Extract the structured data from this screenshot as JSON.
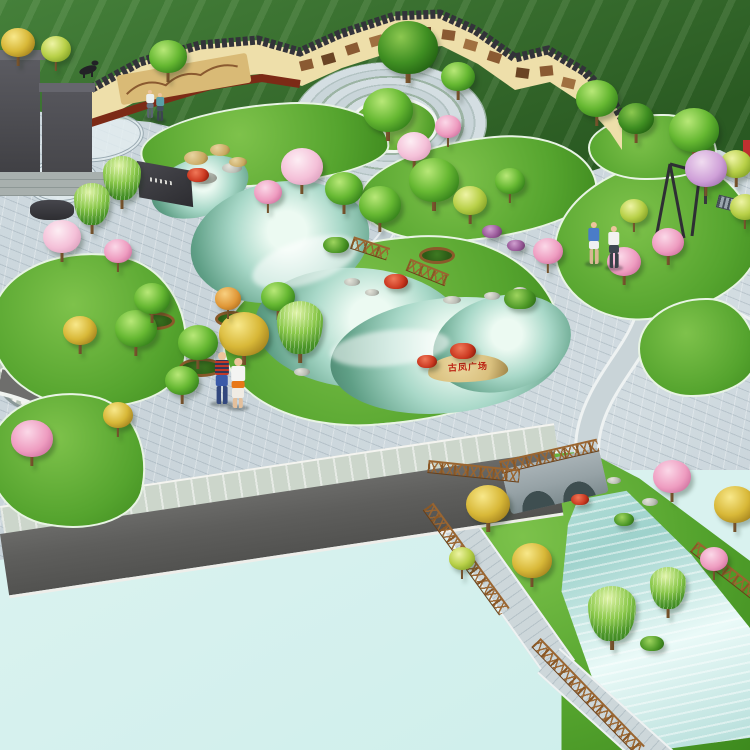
{
  "scene": {
    "title": "Bird's-eye landscape rendering of a cultural plaza park with pond, mural wall, lake and stream garden",
    "inscription": {
      "text": "古凤广场"
    }
  },
  "palette": {
    "field1": "#45803a",
    "field2": "#2a5a22",
    "plaza": "#c9d4da",
    "lawn": "#55a42e",
    "lawnLight": "#7ec24b",
    "lawnEdge": "#e8f4e4",
    "pond": "#5f9f86",
    "pondHi": "#ecfaf2",
    "pale": "#d9f2ef",
    "road": "#5e5e5c",
    "stone": "#d9c07e",
    "insc": "#bc2414",
    "fence": "#8a5826",
    "fenceTop": "#9a6530",
    "bridge": "#96a2a6",
    "arch": "#3e4e50",
    "trunk": "#6b4a26",
    "rock": "#b9bcb4",
    "skin": "#edc49c"
  },
  "trees": [
    {
      "t": "y",
      "x": 18,
      "y": 44,
      "r": 17
    },
    {
      "t": "yg",
      "x": 56,
      "y": 50,
      "r": 15
    },
    {
      "t": "g",
      "x": 168,
      "y": 58,
      "r": 19
    },
    {
      "t": "dg",
      "x": 408,
      "y": 50,
      "r": 30
    },
    {
      "t": "g",
      "x": 458,
      "y": 78,
      "r": 17
    },
    {
      "t": "g",
      "x": 597,
      "y": 100,
      "r": 21
    },
    {
      "t": "dg",
      "x": 636,
      "y": 120,
      "r": 18
    },
    {
      "t": "g",
      "x": 694,
      "y": 132,
      "r": 25
    },
    {
      "t": "yg",
      "x": 736,
      "y": 165,
      "r": 16
    },
    {
      "t": "g",
      "x": 388,
      "y": 112,
      "r": 25
    },
    {
      "t": "lav",
      "x": 706,
      "y": 170,
      "r": 21
    },
    {
      "t": "yg",
      "x": 634,
      "y": 212,
      "r": 14
    },
    {
      "t": "p",
      "x": 668,
      "y": 243,
      "r": 16
    },
    {
      "t": "p",
      "x": 624,
      "y": 263,
      "r": 17
    },
    {
      "t": "yg",
      "x": 745,
      "y": 208,
      "r": 15
    },
    {
      "t": "w",
      "x": 122,
      "y": 180,
      "r": 19
    },
    {
      "t": "r",
      "x": 198,
      "y": 176,
      "r": 11
    },
    {
      "t": "lp",
      "x": 302,
      "y": 168,
      "r": 21
    },
    {
      "t": "p",
      "x": 268,
      "y": 193,
      "r": 14
    },
    {
      "t": "g",
      "x": 344,
      "y": 190,
      "r": 19
    },
    {
      "t": "g",
      "x": 380,
      "y": 206,
      "r": 21
    },
    {
      "t": "g",
      "x": 434,
      "y": 182,
      "r": 25
    },
    {
      "t": "yg",
      "x": 470,
      "y": 202,
      "r": 17
    },
    {
      "t": "lp",
      "x": 414,
      "y": 148,
      "r": 17
    },
    {
      "t": "p",
      "x": 448,
      "y": 128,
      "r": 13
    },
    {
      "t": "g",
      "x": 510,
      "y": 182,
      "r": 15
    },
    {
      "t": "w",
      "x": 300,
      "y": 330,
      "r": 23
    },
    {
      "t": "y",
      "x": 244,
      "y": 336,
      "r": 25
    },
    {
      "t": "g",
      "x": 278,
      "y": 298,
      "r": 17
    },
    {
      "t": "r",
      "x": 396,
      "y": 282,
      "r": 12
    },
    {
      "t": "r",
      "x": 463,
      "y": 352,
      "r": 13
    },
    {
      "t": "r",
      "x": 427,
      "y": 362,
      "r": 10
    },
    {
      "t": "b",
      "x": 336,
      "y": 246,
      "r": 13
    },
    {
      "t": "b",
      "x": 520,
      "y": 300,
      "r": 16
    },
    {
      "t": "p",
      "x": 548,
      "y": 252,
      "r": 15
    },
    {
      "t": "pu",
      "x": 492,
      "y": 232,
      "r": 10
    },
    {
      "t": "pu",
      "x": 516,
      "y": 246,
      "r": 9
    },
    {
      "t": "lp",
      "x": 62,
      "y": 238,
      "r": 19
    },
    {
      "t": "w",
      "x": 92,
      "y": 206,
      "r": 18
    },
    {
      "t": "p",
      "x": 118,
      "y": 252,
      "r": 14
    },
    {
      "t": "g",
      "x": 136,
      "y": 330,
      "r": 21
    },
    {
      "t": "y",
      "x": 80,
      "y": 332,
      "r": 17
    },
    {
      "t": "p",
      "x": 32,
      "y": 440,
      "r": 21
    },
    {
      "t": "y",
      "x": 118,
      "y": 416,
      "r": 15
    },
    {
      "t": "g",
      "x": 182,
      "y": 382,
      "r": 17
    },
    {
      "t": "g",
      "x": 152,
      "y": 300,
      "r": 18
    },
    {
      "t": "g",
      "x": 198,
      "y": 344,
      "r": 20
    },
    {
      "t": "o",
      "x": 228,
      "y": 300,
      "r": 13
    },
    {
      "t": "y",
      "x": 488,
      "y": 506,
      "r": 22
    },
    {
      "t": "y",
      "x": 532,
      "y": 562,
      "r": 20
    },
    {
      "t": "p",
      "x": 672,
      "y": 478,
      "r": 19
    },
    {
      "t": "y",
      "x": 735,
      "y": 506,
      "r": 21
    },
    {
      "t": "p",
      "x": 714,
      "y": 560,
      "r": 14
    },
    {
      "t": "w",
      "x": 612,
      "y": 616,
      "r": 24
    },
    {
      "t": "w",
      "x": 668,
      "y": 590,
      "r": 18
    },
    {
      "t": "b",
      "x": 652,
      "y": 644,
      "r": 12
    },
    {
      "t": "yg",
      "x": 462,
      "y": 560,
      "r": 13
    },
    {
      "t": "r",
      "x": 580,
      "y": 500,
      "r": 9
    },
    {
      "t": "b",
      "x": 624,
      "y": 520,
      "r": 10
    }
  ],
  "people": [
    {
      "x": 150,
      "y": 118,
      "h": 28,
      "top": "#ecf0f0",
      "lower": "#6a7888",
      "legs": "#5a6470"
    },
    {
      "x": 160,
      "y": 121,
      "h": 28,
      "top": "#5aa0a8",
      "lower": "#445060",
      "legs": "#3c4450"
    },
    {
      "x": 222,
      "y": 404,
      "h": 52,
      "top": "stripe",
      "lower": "#3a5aa8",
      "legs": "#32487e"
    },
    {
      "x": 238,
      "y": 408,
      "h": 50,
      "top": "#f4f4f2",
      "mid": "#e87818",
      "lower": "#f0ece4",
      "legs": "#e4c09c"
    },
    {
      "x": 594,
      "y": 264,
      "h": 42,
      "top": "#4a7cc8",
      "lower": "#eef0f2",
      "legs": "#d8b894"
    },
    {
      "x": 614,
      "y": 268,
      "h": 42,
      "top": "#f2f2f0",
      "lower": "#3e4650",
      "legs": "#384048"
    }
  ],
  "rocks": [
    {
      "x": 204,
      "y": 178,
      "w": 26,
      "h": 12
    },
    {
      "x": 232,
      "y": 168,
      "w": 20,
      "h": 10
    },
    {
      "x": 352,
      "y": 282,
      "w": 16,
      "h": 8
    },
    {
      "x": 372,
      "y": 292,
      "w": 14,
      "h": 7
    },
    {
      "x": 452,
      "y": 300,
      "w": 18,
      "h": 8
    },
    {
      "x": 492,
      "y": 296,
      "w": 16,
      "h": 8
    },
    {
      "x": 520,
      "y": 290,
      "w": 14,
      "h": 7
    },
    {
      "x": 302,
      "y": 372,
      "w": 16,
      "h": 8
    },
    {
      "x": 590,
      "y": 470,
      "w": 16,
      "h": 8
    },
    {
      "x": 614,
      "y": 480,
      "w": 14,
      "h": 7
    },
    {
      "x": 650,
      "y": 502,
      "w": 16,
      "h": 8
    }
  ],
  "tan_rocks": [
    {
      "x": 196,
      "y": 158,
      "w": 24,
      "h": 14
    },
    {
      "x": 220,
      "y": 150,
      "w": 20,
      "h": 12
    },
    {
      "x": 238,
      "y": 162,
      "w": 18,
      "h": 10
    }
  ],
  "planters": [
    {
      "x": 152,
      "y": 318,
      "w": 34,
      "h": 12
    },
    {
      "x": 198,
      "y": 364,
      "w": 38,
      "h": 13
    },
    {
      "x": 434,
      "y": 252,
      "w": 30,
      "h": 11
    },
    {
      "x": 228,
      "y": 316,
      "w": 26,
      "h": 10
    }
  ],
  "fences": [
    {
      "x": 352,
      "y": 236,
      "len": 38,
      "rot": 18
    },
    {
      "x": 408,
      "y": 258,
      "len": 42,
      "rot": 22
    },
    {
      "x": 428,
      "y": 460,
      "len": 92,
      "rot": 6
    },
    {
      "x": 428,
      "y": 500,
      "len": 130,
      "rot": 54
    },
    {
      "x": 536,
      "y": 636,
      "len": 150,
      "rot": 46
    },
    {
      "x": 694,
      "y": 540,
      "len": 80,
      "rot": 38
    }
  ]
}
